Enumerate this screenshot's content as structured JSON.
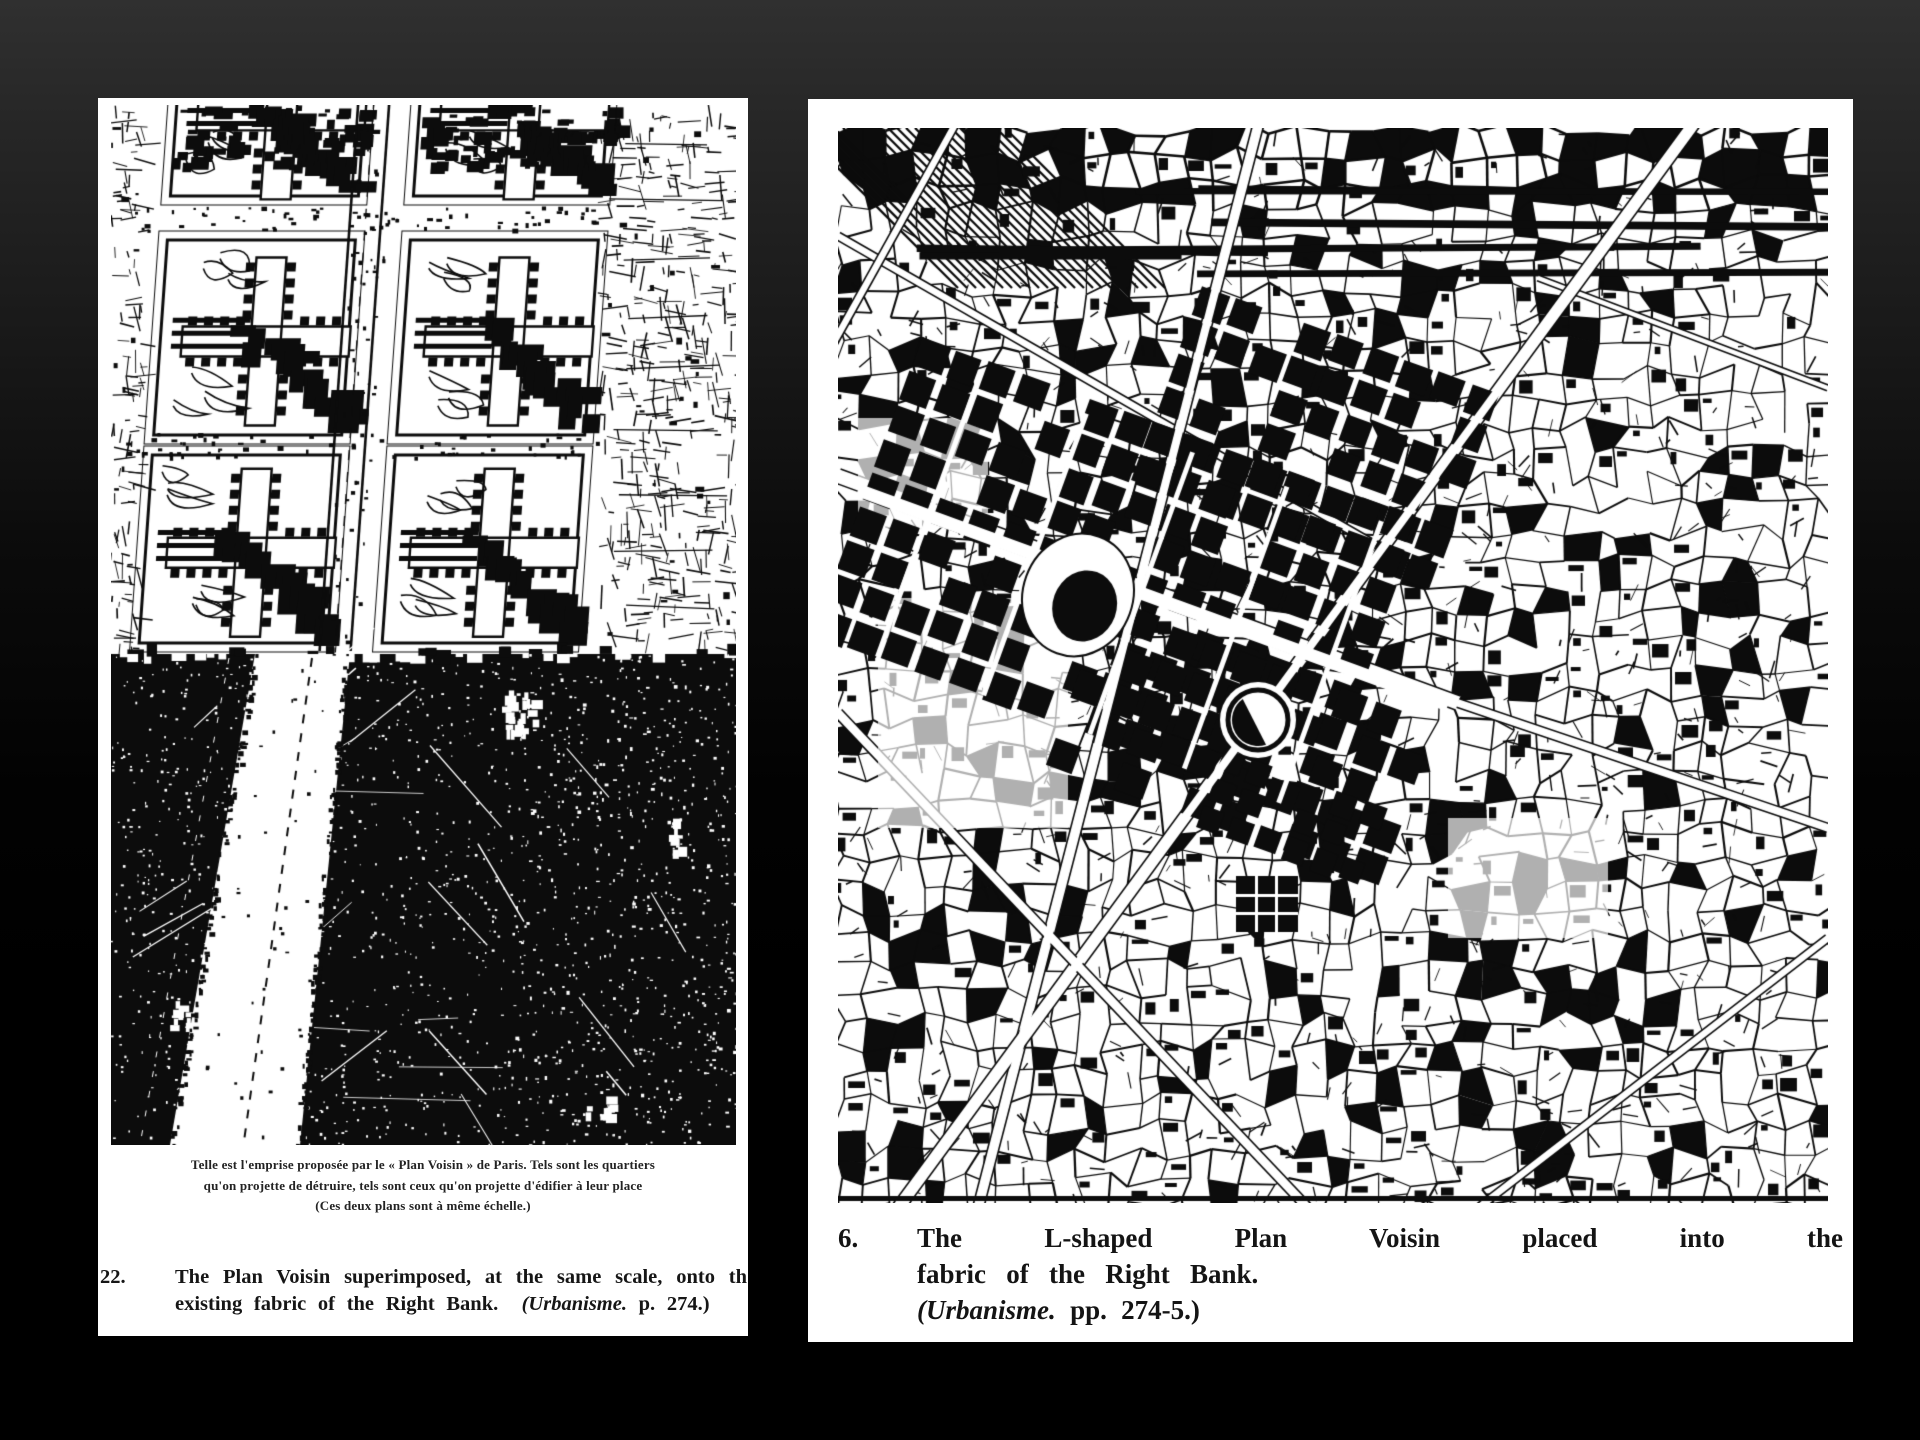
{
  "slide": {
    "background_top_color": "#303030",
    "background_bottom_color": "#000000",
    "page_color": "#ffffff",
    "ink_color": "#111111"
  },
  "left_page": {
    "figure_alt": "Aerial montage: the Plan Voisin grid of cruciform towers superimposed on an aerial photograph of central Paris, with a wide highway running diagonally through",
    "french_caption": {
      "line1": "Telle est l'emprise proposée par le « Plan Voisin » de Paris. Tels sont les quartiers",
      "line2": "qu'on projette de détruire, tels sont ceux qu'on projette d'édifier à leur place",
      "line3": "(Ces deux plans sont à même échelle.)"
    },
    "figure_number": "22.",
    "caption": {
      "line1": "The Plan Voisin superimposed, at the same scale, onto th",
      "line2_text": "existing fabric of the Right Bank.",
      "line2_source_italic": "(Urbanisme.",
      "line2_source_rest": " p. 274.)"
    }
  },
  "right_page": {
    "figure_alt": "Scanned street map of the Right Bank of Paris with the L-shaped Plan Voisin block grid drawn into the existing fabric",
    "figure_number": "6.",
    "caption": {
      "line1": "The L-shaped Plan Voisin placed into the",
      "line2": "fabric of the Right Bank.",
      "line3_source_italic": "(Urbanisme.",
      "line3_source_rest": " pp. 274-5.)"
    }
  }
}
